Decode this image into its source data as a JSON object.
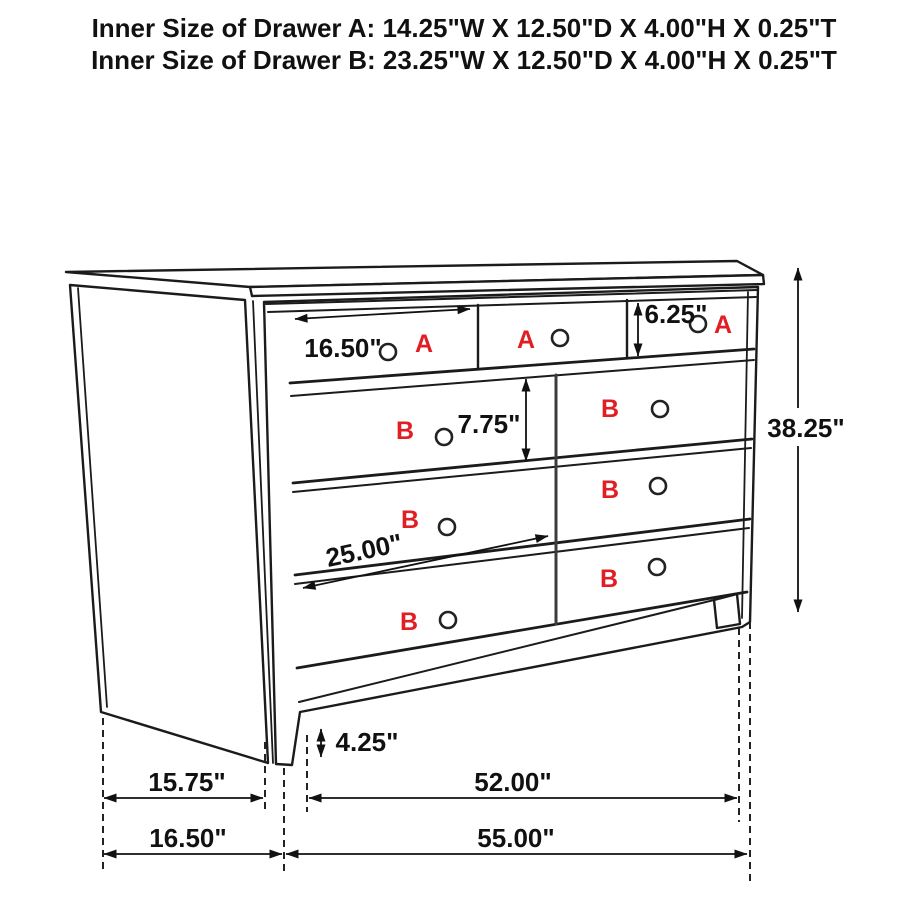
{
  "title": {
    "line1": "Inner Size of Drawer A: 14.25\"W X 12.50\"D X 4.00\"H X 0.25\"T",
    "line2": "Inner Size of Drawer B: 23.25\"W X 12.50\"D X 4.00\"H X 0.25\"T"
  },
  "colors": {
    "label_red": "#e01e24",
    "line_black": "#1a1a1a"
  },
  "drawer_labels": {
    "a1": "A",
    "a2": "A",
    "a3": "A",
    "bl1": "B",
    "bl2": "B",
    "bl3": "B",
    "br1": "B",
    "br2": "B",
    "br3": "B"
  },
  "dimensions": {
    "drawer_a_width": "16.50\"",
    "drawer_a_height": "6.25\"",
    "drawer_b_height": "7.75\"",
    "drawer_b_width": "25.00\"",
    "overall_height": "38.25\"",
    "leg_height": "4.25\"",
    "side_depth": "15.75\"",
    "base_width": "52.00\"",
    "side_depth_total": "16.50\"",
    "overall_width": "55.00\""
  }
}
